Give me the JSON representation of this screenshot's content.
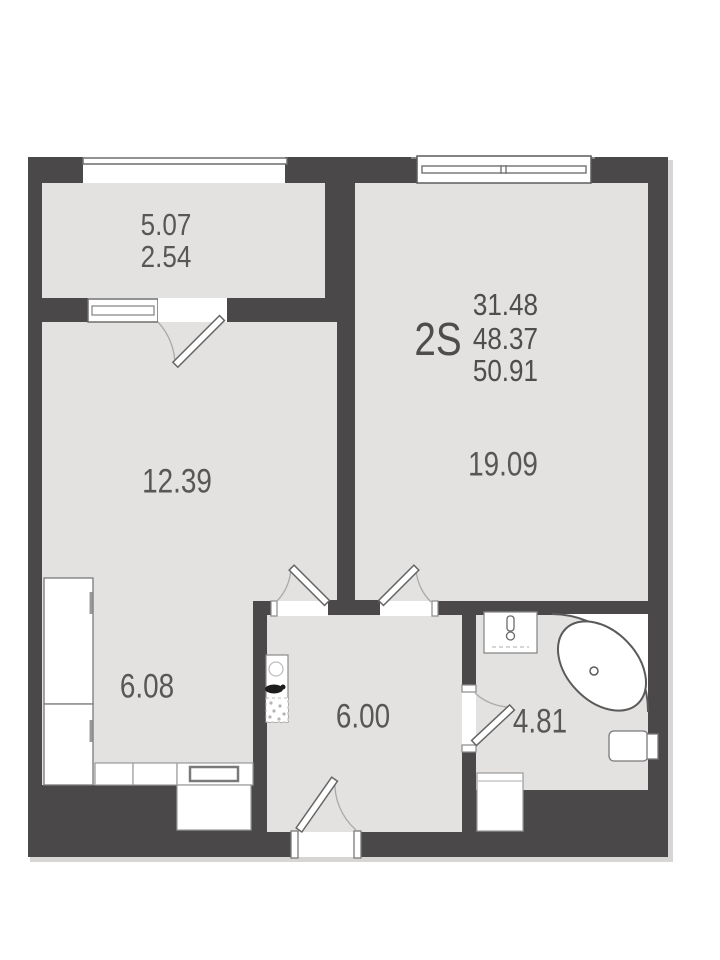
{
  "unit": {
    "type": "2S",
    "area_line1": "31.48",
    "area_line2": "48.37",
    "area_line3": "50.91"
  },
  "rooms": {
    "balcony_full": "5.07",
    "balcony_reduced": "2.54",
    "room": "12.39",
    "living": "19.09",
    "kitchen": "6.08",
    "hall": "6.00",
    "bath": "4.81"
  },
  "colors": {
    "wall": "#4a4848",
    "floor": "#e3e2e0",
    "fixture_line": "#777777",
    "door_arc": "#aaaaaa",
    "label_text": "#575757"
  }
}
